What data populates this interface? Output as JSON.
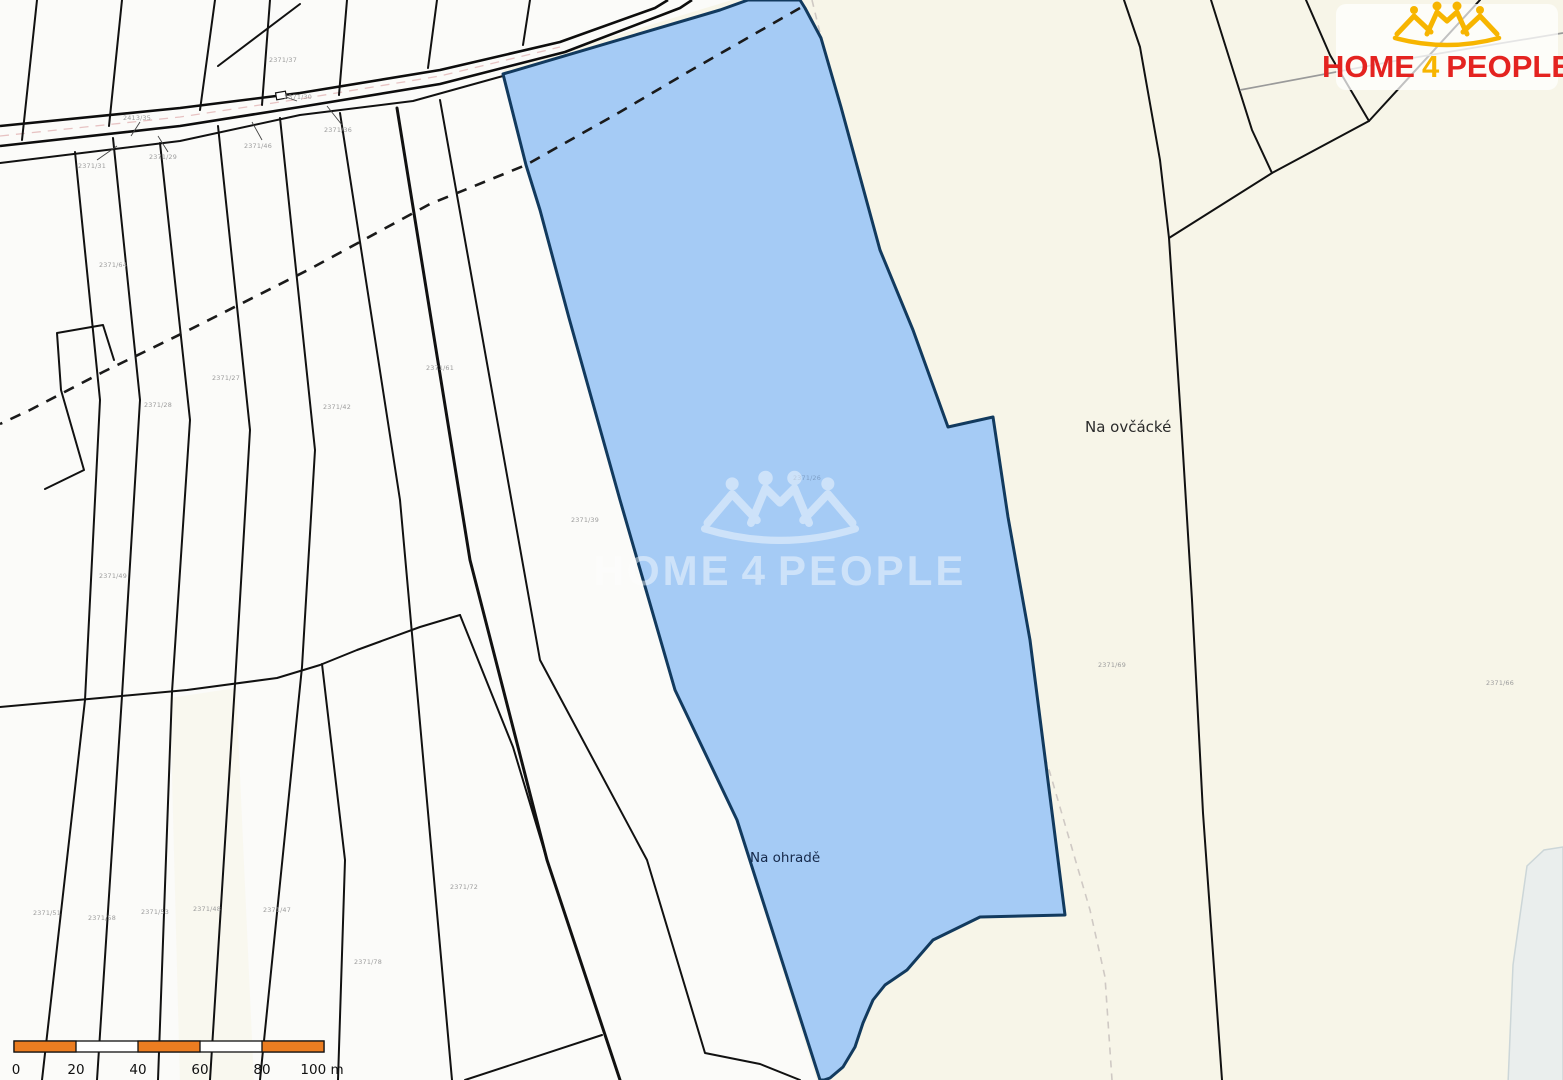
{
  "brand": {
    "home": "HOME",
    "four": "4",
    "people": "PEOPLE",
    "color_red": "#e42320",
    "color_gold": "#f7b500"
  },
  "watermark": {
    "home": "HOME",
    "four": "4",
    "people": "PEOPLE"
  },
  "map": {
    "type": "cadastral-parcel-map",
    "highlight_fill": "#a5cbf5",
    "highlight_border": "#123a5e",
    "background_left": "#fbfbf9",
    "background_right": "#f7f5e8",
    "street_labels": {
      "na_ovcacke": "Na ovčácké",
      "na_ohrade": "Na ohradě"
    },
    "parcel_numbers": [
      {
        "t": "2371/37"
      },
      {
        "t": "2413/35"
      },
      {
        "t": "2371/31"
      },
      {
        "t": "2371/29"
      },
      {
        "t": "2371/46"
      },
      {
        "t": "2371/36"
      },
      {
        "t": "2371/30"
      },
      {
        "t": "2371/64"
      },
      {
        "t": "2371/28"
      },
      {
        "t": "2371/27"
      },
      {
        "t": "2371/42"
      },
      {
        "t": "2371/61"
      },
      {
        "t": "2371/39"
      },
      {
        "t": "2371/26"
      },
      {
        "t": "2371/49"
      },
      {
        "t": "2371/51"
      },
      {
        "t": "2371/58"
      },
      {
        "t": "2371/53"
      },
      {
        "t": "2371/48"
      },
      {
        "t": "2371/47"
      },
      {
        "t": "2371/78"
      },
      {
        "t": "2371/72"
      },
      {
        "t": "2371/69"
      },
      {
        "t": "2371/66"
      }
    ]
  },
  "scale_bar": {
    "ticks": [
      "0",
      "20",
      "40",
      "60",
      "80",
      "100 m"
    ],
    "bar_color": "#ec7d21"
  }
}
